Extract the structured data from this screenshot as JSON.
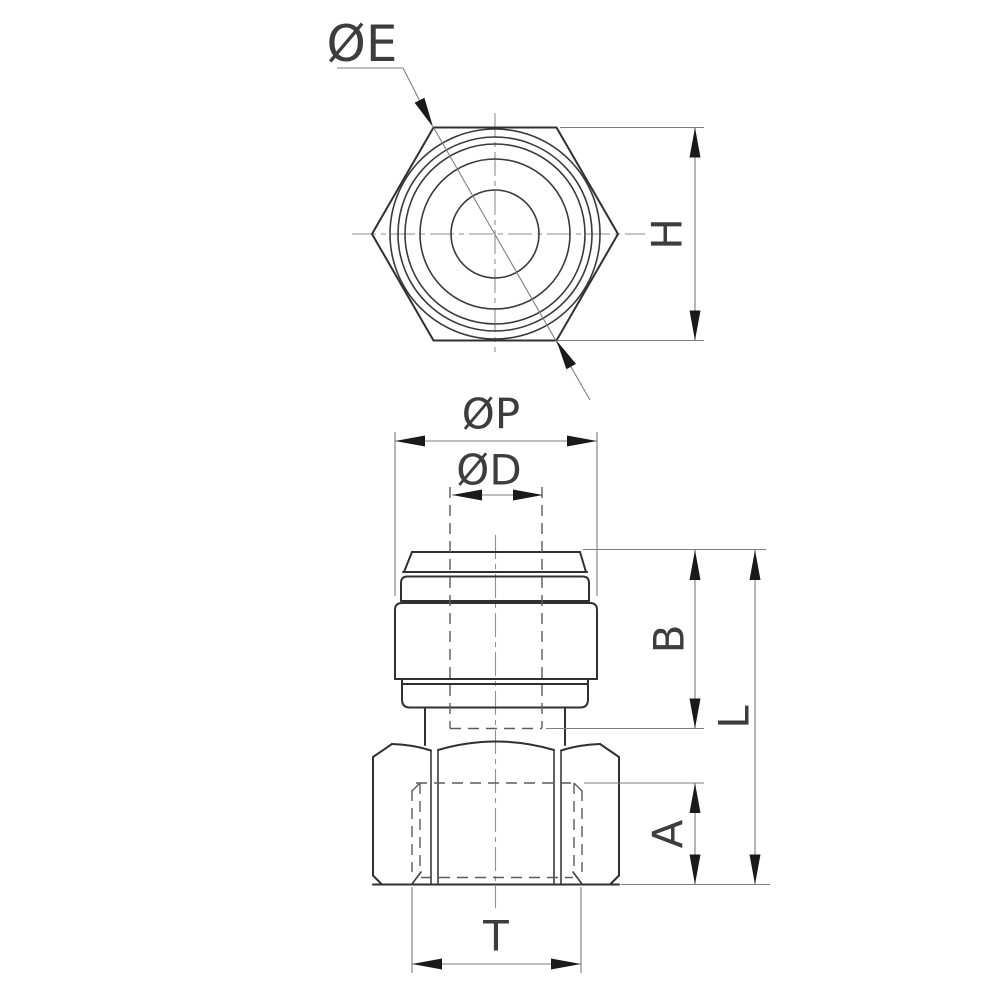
{
  "drawing": {
    "description": "Technical drawing of a push-in tube fitting (female straight connector) with hexagonal nut, top view and front view",
    "colors": {
      "background": "#ffffff",
      "outline": "#303030",
      "thin_line": "#7f7f7f",
      "hidden_line": "#5c5c5c",
      "arrow": "#1a1a1a"
    },
    "labels": {
      "diameter_e": "ØE",
      "height_h": "H",
      "diameter_p": "ØP",
      "diameter_d": "ØD",
      "dim_b": "B",
      "dim_l": "L",
      "dim_a": "A",
      "dim_t": "T"
    }
  }
}
